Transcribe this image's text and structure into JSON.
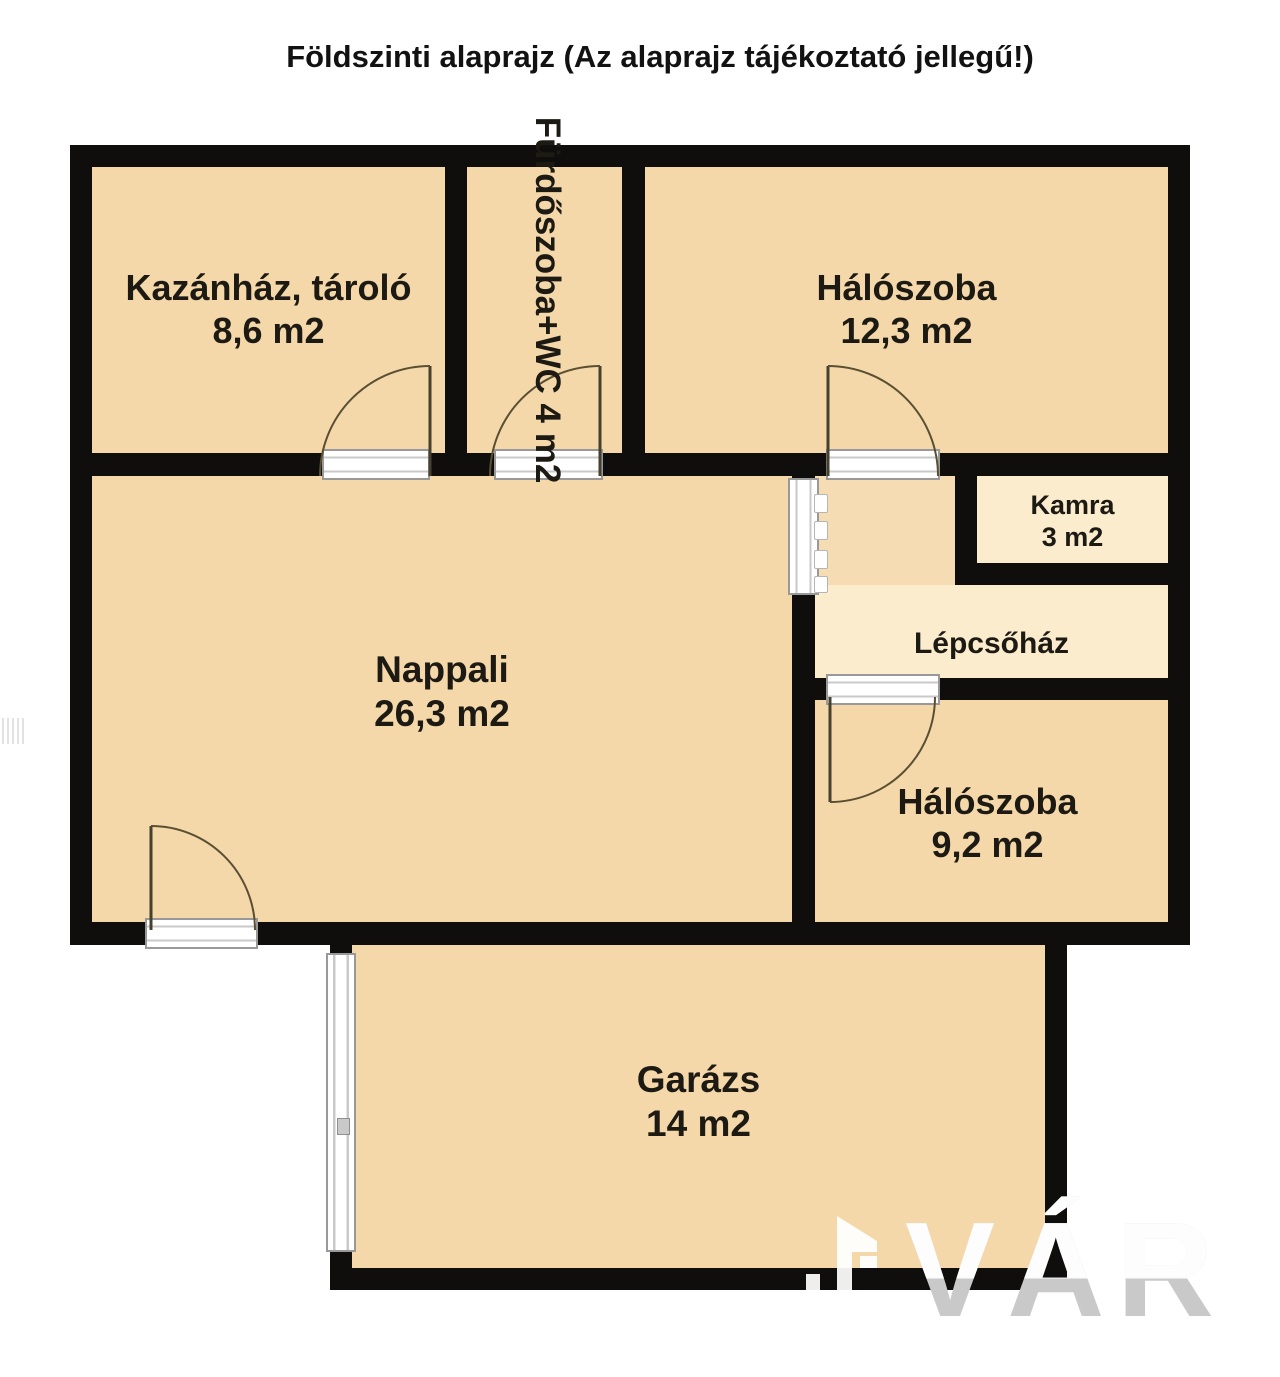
{
  "title": {
    "line1": "Földszinti alaprajz",
    "line2": "(Az alaprajz tájékoztató jellegű!)"
  },
  "rooms": {
    "kazanhaz": {
      "name": "Kazánház, tároló",
      "area": "8,6 m2"
    },
    "furdoszoba": {
      "name": "Fürdőszoba+WC",
      "area": "4 m2"
    },
    "haloszoba_nagy": {
      "name": "Hálószoba",
      "area": "12,3 m2"
    },
    "kamra": {
      "name": "Kamra",
      "area": "3 m2"
    },
    "lepcsohaz": {
      "name": "Lépcsőház"
    },
    "nappali": {
      "name": "Nappali",
      "area": "26,3 m2"
    },
    "haloszoba_kis": {
      "name": "Hálószoba",
      "area": "9,2 m2"
    },
    "garazs": {
      "name": "Garázs",
      "area": "14 m2"
    }
  },
  "watermark": {
    "text": "VÁR"
  },
  "colors": {
    "wall": "#0f0e0c",
    "room_fill": "#f4d8a9",
    "corridor_fill": "#f6dcb3",
    "service_fill": "#faeccd",
    "door_arc": "#5a4f33",
    "background": "#ffffff"
  }
}
